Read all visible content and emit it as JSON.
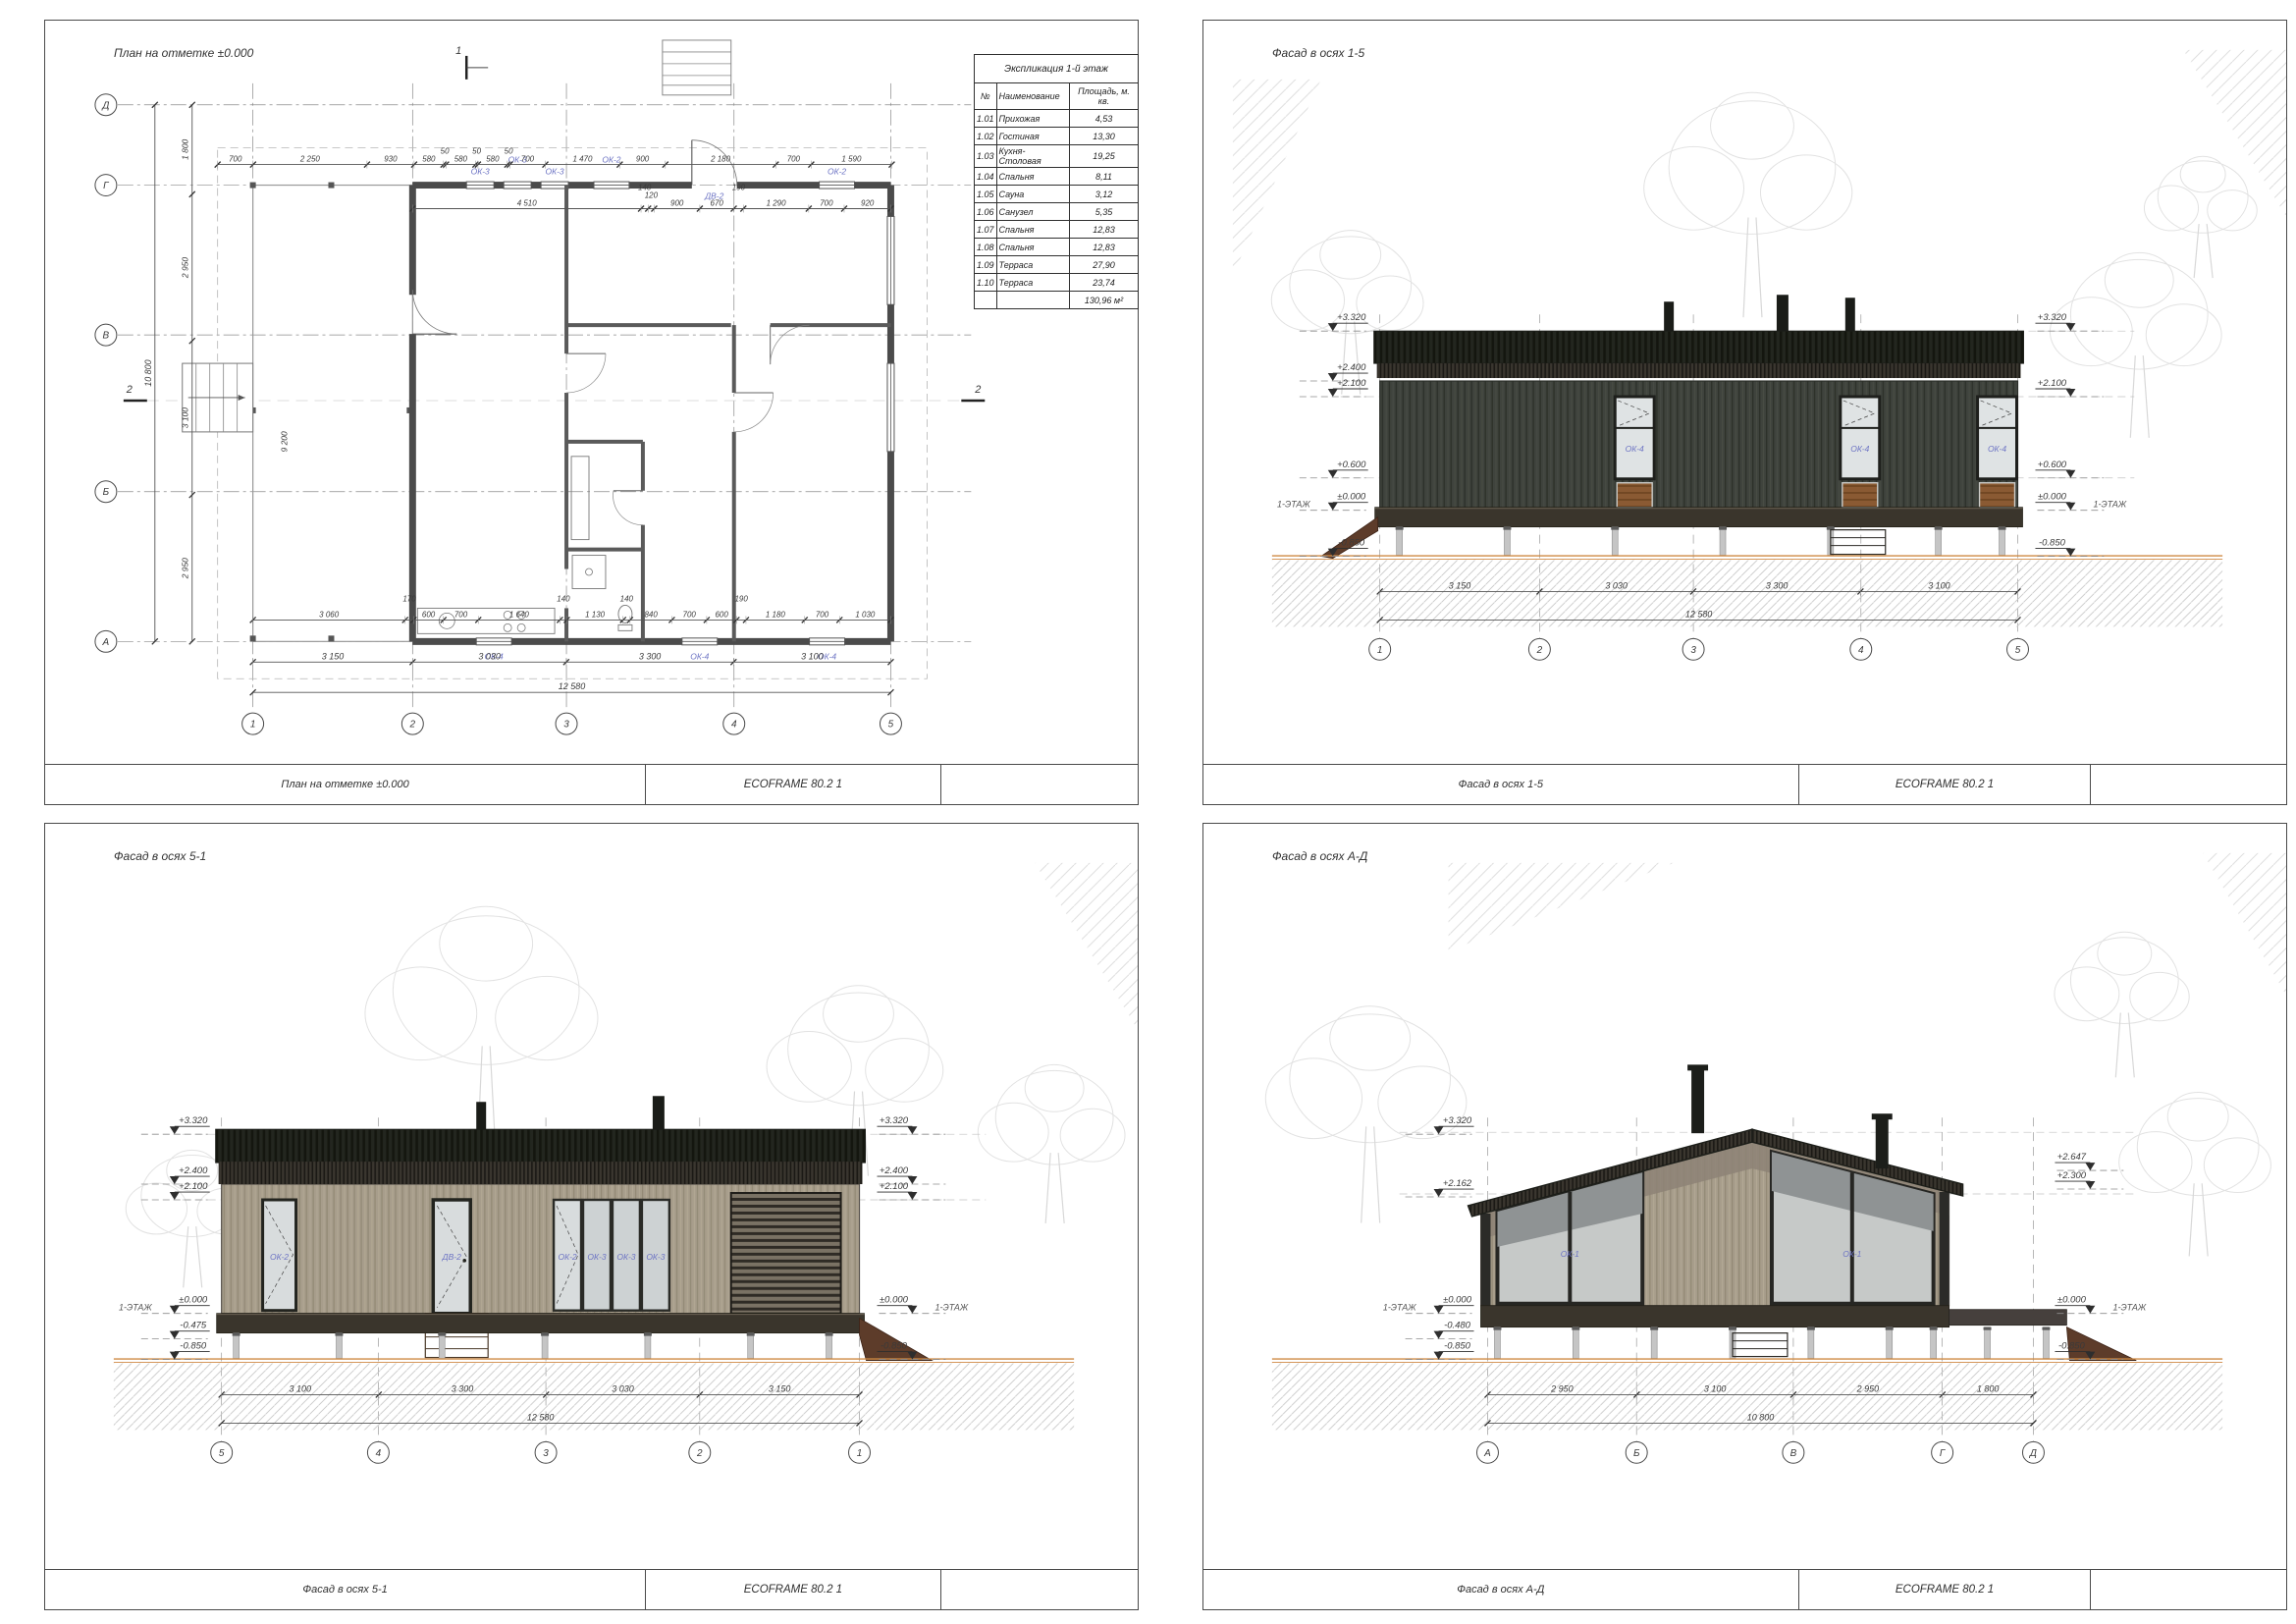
{
  "sheet": {
    "accent_blue": "#6d74c4",
    "ground_orange": "#cf8a44",
    "project_label": "ECOFRAME 80.2 1"
  },
  "plan": {
    "caption": "План на отметке ±0.000",
    "schedule": {
      "title": "Экспликация 1-й этаж",
      "col_num": "№",
      "col_name": "Наименование",
      "col_area": "Площадь, м. кв.",
      "rows": [
        {
          "num": "1.01",
          "name": "Прихожая",
          "area": "4,53"
        },
        {
          "num": "1.02",
          "name": "Гостиная",
          "area": "13,30"
        },
        {
          "num": "1.03",
          "name": "Кухня-Столовая",
          "area": "19,25"
        },
        {
          "num": "1.04",
          "name": "Спальня",
          "area": "8,11"
        },
        {
          "num": "1.05",
          "name": "Сауна",
          "area": "3,12"
        },
        {
          "num": "1.06",
          "name": "Санузел",
          "area": "5,35"
        },
        {
          "num": "1.07",
          "name": "Спальня",
          "area": "12,83"
        },
        {
          "num": "1.08",
          "name": "Спальня",
          "area": "12,83"
        },
        {
          "num": "1.09",
          "name": "Терраса",
          "area": "27,90"
        },
        {
          "num": "1.10",
          "name": "Терраса",
          "area": "23,74"
        }
      ],
      "total": "130,96 м²"
    },
    "axes_cols": [
      "1",
      "2",
      "3",
      "4",
      "5"
    ],
    "axes_rows": [
      "Д",
      "Г",
      "В",
      "Б",
      "А"
    ],
    "dims_top": [
      "700",
      "2 250",
      "930",
      "580",
      "50",
      "580",
      "50",
      "580",
      "50",
      "700",
      "1 470",
      "900",
      "2 180",
      "700",
      "1 590"
    ],
    "dims_upper_inner": [
      "4 510",
      "140",
      "120",
      "900",
      "670",
      "190",
      "1 290",
      "700",
      "920"
    ],
    "dims_lower_inner": [
      "3 060",
      "170",
      "600",
      "700",
      "1 640",
      "140",
      "1 130",
      "140",
      "840",
      "700",
      "600",
      "190",
      "1 180",
      "700",
      "1 030"
    ],
    "dims_bottom": [
      "3 150",
      "3 030",
      "3 300",
      "3 100"
    ],
    "dim_bottom_total": "12 580",
    "dims_left": [
      "1 800",
      "2 950",
      "3 100",
      "2 950"
    ],
    "dim_left_total": "10 800",
    "dim_vert_inner": "9 200",
    "window_tags_top": [
      "ОК-3",
      "ОК-3",
      "ОК-3",
      "ОК-2",
      "ДВ-2",
      "ОК-2"
    ],
    "window_tags_bottom": [
      "ОК-4",
      "ОК-4",
      "ОК-4"
    ],
    "section_mark_1": "1",
    "section_mark_2": "2"
  },
  "facade15": {
    "caption": "Фасад в осях 1-5",
    "marks_left": [
      "+3.320",
      "+2.400",
      "+2.100",
      "+0.600",
      "±0.000",
      "-0.850"
    ],
    "marks_right": [
      "+3.320",
      "+2.100",
      "+0.600",
      "±0.000",
      "-0.850"
    ],
    "floor_label": "1-ЭТАЖ",
    "window_tags": [
      "ОК-4",
      "ОК-4",
      "ОК-4"
    ],
    "dims": [
      "3 150",
      "3 030",
      "3 300",
      "3 100"
    ],
    "dim_total": "12 580",
    "axes": [
      "1",
      "2",
      "3",
      "4",
      "5"
    ]
  },
  "facade51": {
    "caption": "Фасад в осях 5-1",
    "marks_left": [
      "+3.320",
      "+2.400",
      "+2.100",
      "±0.000",
      "-0.475",
      "-0.850"
    ],
    "marks_right": [
      "+3.320",
      "+2.400",
      "+2.100",
      "±0.000",
      "-0.850"
    ],
    "floor_label": "1-ЭТАЖ",
    "window_tags": [
      "ОК-2",
      "ДВ-2",
      "ОК-2",
      "ОК-3",
      "ОК-3",
      "ОК-3"
    ],
    "dims": [
      "3 100",
      "3 300",
      "3 030",
      "3 150"
    ],
    "dim_total": "12 580",
    "axes": [
      "5",
      "4",
      "3",
      "2",
      "1"
    ]
  },
  "facadeAD": {
    "caption": "Фасад в осях А-Д",
    "marks_left": [
      "+3.320",
      "+2.162",
      "±0.000",
      "-0.480",
      "-0.850"
    ],
    "marks_right": [
      "+2.647",
      "+2.300",
      "±0.000",
      "-0.850"
    ],
    "floor_label": "1-ЭТАЖ",
    "window_tags": [
      "ОК-1",
      "ОК-1"
    ],
    "dims": [
      "2 950",
      "3 100",
      "2 950",
      "1 800"
    ],
    "dim_total": "10 800",
    "axes": [
      "А",
      "Б",
      "В",
      "Г",
      "Д"
    ]
  }
}
